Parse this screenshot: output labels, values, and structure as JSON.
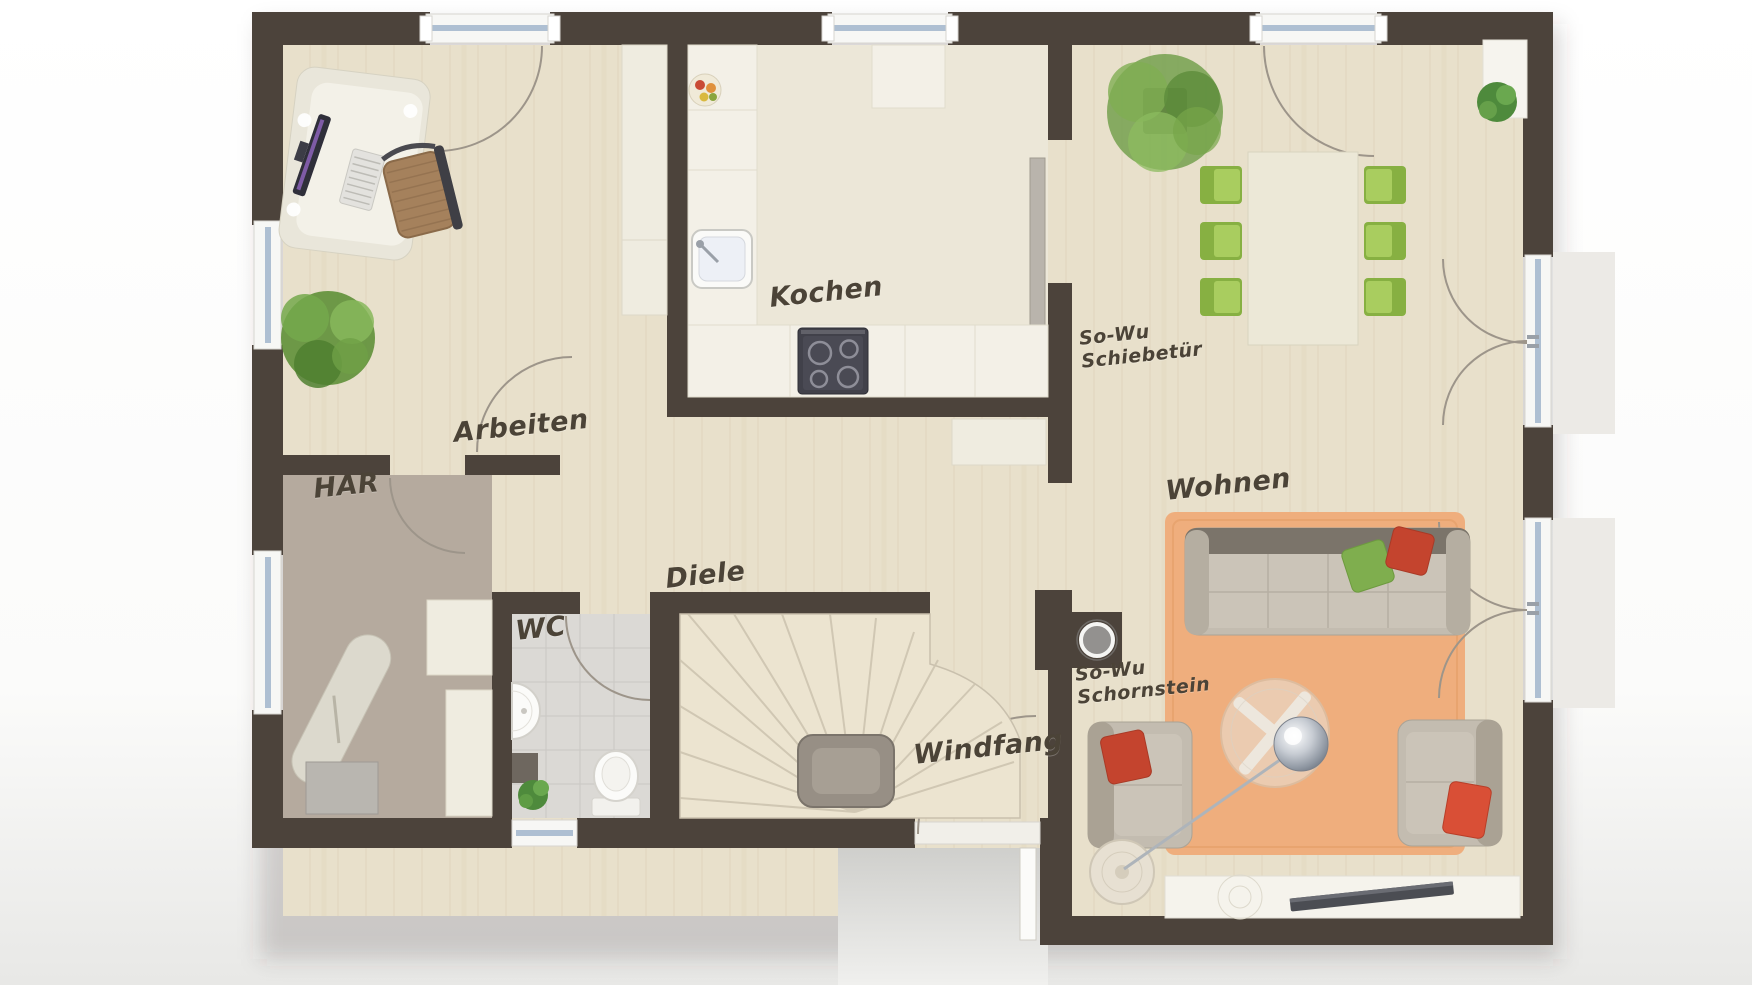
{
  "floorplan": {
    "title": "Erdgeschoss Grundriss",
    "rooms": [
      {
        "id": "arbeiten",
        "label": "Arbeiten"
      },
      {
        "id": "kochen",
        "label": "Kochen"
      },
      {
        "id": "har",
        "label": "HAR"
      },
      {
        "id": "wc",
        "label": "WC"
      },
      {
        "id": "diele",
        "label": "Diele"
      },
      {
        "id": "windfang",
        "label": "Windfang"
      },
      {
        "id": "wohnen",
        "label": "Wohnen"
      }
    ],
    "annotations": [
      {
        "id": "sliding-door-note",
        "line1": "So-Wu",
        "line2": "Schiebetür"
      },
      {
        "id": "chimney-note",
        "line1": "So-Wu",
        "line2": "Schornstein"
      }
    ],
    "colors": {
      "wall": "#4c433b",
      "wood_floor": "#e8e0cb",
      "kitchen_floor": "#ece7d8",
      "har_floor": "#b5aa9e",
      "wc_floor": "#dbd9d5",
      "rug": "#efae7d",
      "dining_chair_green": "#87b042",
      "pillow_red": "#c4442e",
      "pillow_green": "#7fae4e",
      "porch": "#d8d8d6",
      "glass": "#aebfd2"
    },
    "furniture_icons": [
      "desk-icon",
      "office-chair-icon",
      "monitor-icon",
      "keyboard-icon",
      "wardrobe-icon",
      "plant-icon",
      "kitchen-sink-icon",
      "stove-icon",
      "fruit-bowl-icon",
      "counter-icon",
      "dining-table-icon",
      "dining-chair-icon",
      "sideboard-icon",
      "sofa-icon",
      "armchair-icon",
      "coffee-table-icon",
      "arc-lamp-icon",
      "tv-lowboard-icon",
      "chimney-icon",
      "sliding-door-icon",
      "stairs-icon",
      "handrail-icon",
      "toilet-icon",
      "wc-sink-icon",
      "shelf-icon",
      "ironing-board-icon",
      "washing-machine-icon",
      "window-icon",
      "door-swing-icon",
      "entrance-door-icon"
    ]
  }
}
